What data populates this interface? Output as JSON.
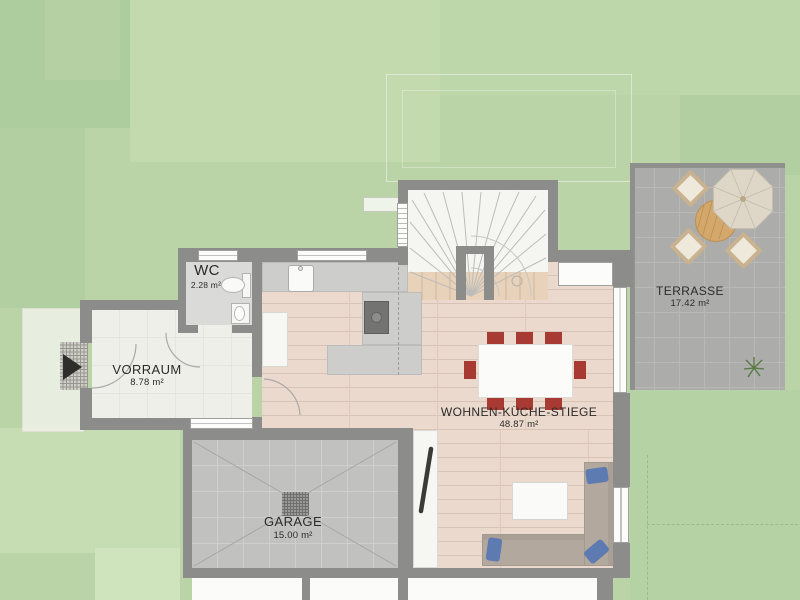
{
  "plan": {
    "type": "architectural-floor-plan",
    "rooms": {
      "wc": {
        "name": "WC",
        "area": "2.28 m²"
      },
      "vorraum": {
        "name": "VORRAUM",
        "area": "8.78 m²"
      },
      "wohnen": {
        "name": "WOHNEN-KÜCHE-STIEGE",
        "area": "48.87 m²"
      },
      "garage": {
        "name": "GARAGE",
        "area": "15.00 m²"
      },
      "terrasse": {
        "name": "TERRASSE",
        "area": "17.42 m²"
      }
    },
    "colors": {
      "grass": "#bad4a8",
      "wall": "#8c8c8a",
      "wood_floor": "#ecd9ce",
      "garage_tile": "#c1c1bf",
      "terrace_tile": "#acacaa",
      "dining_chair_red": "#a83a34",
      "sofa_pillow_blue": "#5d7ab1",
      "outdoor_furniture_tan": "#c8b28f",
      "label_text": "#2b2b29"
    },
    "icons": {
      "entrance_arrow": "right-pointing-triangle",
      "floor_drain": "grid-square",
      "parasol": "octagon-umbrella"
    }
  }
}
